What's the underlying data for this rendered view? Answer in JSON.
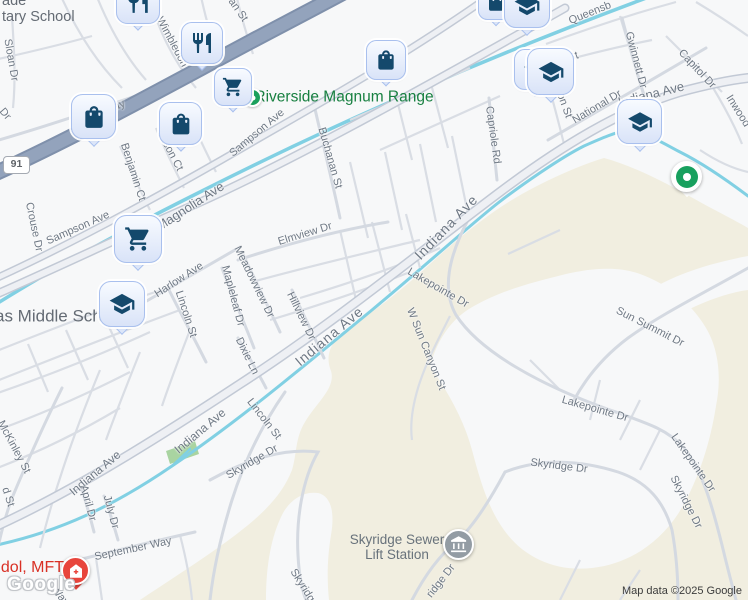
{
  "map": {
    "attribution": "Map data ©2025 Google",
    "watermark": "Google",
    "highway_badge": "91",
    "colors": {
      "urban": "#f7f8f9",
      "terrain": "#f1eee0",
      "water": "#81d0e3",
      "freeway": "#93a3bc",
      "arterial_casing": "#c2c9d5",
      "local_road": "#d9dde4",
      "park": "#a9d4a1",
      "pin_glyph": "#14496c",
      "pin_fill": "#dce6f9",
      "poi_green": "#188041",
      "poi_red": "#d93025",
      "label_gray": "#6e7884"
    },
    "place_labels": [
      {
        "name": "elementary-school-label",
        "lines": [
          "ade",
          "tary School"
        ],
        "x": 2,
        "y": -7,
        "s": 14.5,
        "cls": "schoolgray",
        "anchor": "tl"
      },
      {
        "name": "riverside-magnum-range-label",
        "lines": [
          "Riverside Magnum Range"
        ],
        "x": 344,
        "y": 97,
        "s": 15.5,
        "cls": "green",
        "anchor": "c"
      },
      {
        "name": "middle-school-label",
        "lines": [
          "gas Middle School"
        ],
        "x": 55,
        "y": 316,
        "s": 17,
        "cls": "schoolgray",
        "anchor": "c"
      },
      {
        "name": "therapist-label",
        "lines": [
          "udol, MFT"
        ],
        "x": 28,
        "y": 568,
        "s": 16,
        "cls": "red",
        "anchor": "c"
      },
      {
        "name": "sewer-lift-station-label",
        "lines": [
          "Skyridge Sewer",
          "Lift Station"
        ],
        "x": 397,
        "y": 547,
        "s": 13.5,
        "cls": "poigray",
        "anchor": "c"
      }
    ],
    "street_labels": [
      {
        "text": "Sloan Dr",
        "x": 11,
        "y": 60,
        "r": 80
      },
      {
        "text": "Dr",
        "x": 5,
        "y": 114,
        "r": 50
      },
      {
        "text": "Griffin Way",
        "x": 100,
        "y": 114,
        "r": -24
      },
      {
        "text": "Wimbledon",
        "x": 172,
        "y": 42,
        "r": 62
      },
      {
        "text": "an St",
        "x": 238,
        "y": 10,
        "r": 55
      },
      {
        "text": "Crouse Dr",
        "x": 34,
        "y": 227,
        "r": 78
      },
      {
        "text": "Sampson Ave",
        "x": 78,
        "y": 228,
        "r": -24
      },
      {
        "text": "Sampson Ave",
        "x": 257,
        "y": 133,
        "r": -40
      },
      {
        "text": "Magnolia Ave",
        "x": 190,
        "y": 206,
        "r": -33,
        "s": 13
      },
      {
        "text": "Benjamin Ct",
        "x": 133,
        "y": 172,
        "r": 72
      },
      {
        "text": "Jason Ct",
        "x": 170,
        "y": 151,
        "r": 62
      },
      {
        "text": "Buchanan St",
        "x": 330,
        "y": 158,
        "r": 74
      },
      {
        "text": "Elmview Dr",
        "x": 305,
        "y": 234,
        "r": -17
      },
      {
        "text": "Harlow Ave",
        "x": 179,
        "y": 280,
        "r": -33
      },
      {
        "text": "Lincoln St",
        "x": 186,
        "y": 314,
        "r": 72
      },
      {
        "text": "Mapleleaf Dr",
        "x": 233,
        "y": 296,
        "r": 75
      },
      {
        "text": "Meadowview Dr",
        "x": 254,
        "y": 282,
        "r": 64
      },
      {
        "text": "Hillview Dr",
        "x": 301,
        "y": 316,
        "r": 64
      },
      {
        "text": "Dixie Ln",
        "x": 247,
        "y": 356,
        "r": 64
      },
      {
        "text": "Indiana Ave",
        "x": 446,
        "y": 227,
        "r": -46,
        "s": 14,
        "ls": 1
      },
      {
        "text": "Indiana Ave",
        "x": 329,
        "y": 336,
        "r": -40,
        "s": 14,
        "ls": 1
      },
      {
        "text": "Indiana Ave",
        "x": 200,
        "y": 431,
        "r": -40,
        "s": 12
      },
      {
        "text": "Indiana Ave",
        "x": 95,
        "y": 473,
        "r": -40,
        "s": 12
      },
      {
        "text": "Indiana Ave",
        "x": 651,
        "y": 94,
        "r": -14,
        "s": 13
      },
      {
        "text": "Capriole Rd",
        "x": 493,
        "y": 135,
        "r": 82
      },
      {
        "text": "National Dr",
        "x": 597,
        "y": 107,
        "r": -31
      },
      {
        "text": "Gwinnett Dr",
        "x": 636,
        "y": 60,
        "r": 75
      },
      {
        "text": "Capitol Dr",
        "x": 697,
        "y": 69,
        "r": 47
      },
      {
        "text": "Queensb",
        "x": 590,
        "y": 13,
        "r": -22
      },
      {
        "text": "Inwood",
        "x": 738,
        "y": 111,
        "r": 58
      },
      {
        "text": "r St",
        "x": 570,
        "y": 58,
        "r": -20
      },
      {
        "text": "ton St",
        "x": 564,
        "y": 104,
        "r": 70
      },
      {
        "text": "Lakepointe Dr",
        "x": 438,
        "y": 288,
        "r": 30
      },
      {
        "text": "W Sun Canyon St",
        "x": 426,
        "y": 349,
        "r": 68
      },
      {
        "text": "Sun Summit Dr",
        "x": 650,
        "y": 327,
        "r": 27
      },
      {
        "text": "Lakepointe Dr",
        "x": 595,
        "y": 409,
        "r": 16
      },
      {
        "text": "Lakepointe Dr",
        "x": 693,
        "y": 463,
        "r": 55
      },
      {
        "text": "Skyridge Dr",
        "x": 559,
        "y": 466,
        "r": 7
      },
      {
        "text": "Skyridge Dr",
        "x": 686,
        "y": 502,
        "r": 63
      },
      {
        "text": "Skyridge Dr",
        "x": 252,
        "y": 462,
        "r": -30
      },
      {
        "text": "Skyridge",
        "x": 304,
        "y": 588,
        "r": 58
      },
      {
        "text": "ridge Dr",
        "x": 441,
        "y": 581,
        "r": -52
      },
      {
        "text": "Lincoln St",
        "x": 264,
        "y": 419,
        "r": 52
      },
      {
        "text": "McKinley St",
        "x": 14,
        "y": 447,
        "r": 62
      },
      {
        "text": "d St",
        "x": 8,
        "y": 497,
        "r": 72
      },
      {
        "text": "April Dr",
        "x": 88,
        "y": 503,
        "r": 75
      },
      {
        "text": "July Dr",
        "x": 111,
        "y": 512,
        "r": 75
      },
      {
        "text": "September Way",
        "x": 133,
        "y": 549,
        "r": -12
      },
      {
        "text": "Way",
        "x": 60,
        "y": 596,
        "r": 50
      }
    ],
    "pins": [
      {
        "name": "restaurant-pin",
        "icon": "restaurant-icon",
        "kind": "sq",
        "x": 116,
        "y": -20,
        "s": 44
      },
      {
        "name": "restaurant-pin",
        "icon": "restaurant-icon",
        "kind": "sq",
        "x": 181,
        "y": 22,
        "s": 42
      },
      {
        "name": "poi-dot",
        "icon": "green-dot-icon",
        "kind": "dot",
        "x": 243,
        "y": 88,
        "s": 19
      },
      {
        "name": "shopping-cart-pin",
        "icon": "shopping-cart-icon",
        "kind": "sq",
        "x": 214,
        "y": 68,
        "s": 38
      },
      {
        "name": "shopping-bag-pin",
        "icon": "shopping-bag-icon",
        "kind": "sq",
        "x": 366,
        "y": 40,
        "s": 40
      },
      {
        "name": "shopping-bag-pin",
        "icon": "shopping-bag-icon",
        "kind": "sq",
        "x": 478,
        "y": -16,
        "s": 36
      },
      {
        "name": "school-pin",
        "icon": "graduation-cap-icon",
        "kind": "sq",
        "x": 504,
        "y": -18,
        "s": 46
      },
      {
        "name": "school-pin",
        "icon": "graduation-cap-icon",
        "kind": "sq",
        "x": 514,
        "y": 49,
        "s": 41
      },
      {
        "name": "school-pin",
        "icon": "graduation-cap-icon",
        "kind": "sq",
        "x": 527,
        "y": 48,
        "s": 47
      },
      {
        "name": "school-pin",
        "icon": "graduation-cap-icon",
        "kind": "sq",
        "x": 617,
        "y": 99,
        "s": 45
      },
      {
        "name": "shopping-bag-pin",
        "icon": "shopping-bag-icon",
        "kind": "sq",
        "x": 71,
        "y": 94,
        "s": 45
      },
      {
        "name": "shopping-bag-pin",
        "icon": "shopping-bag-icon",
        "kind": "sq",
        "x": 159,
        "y": 102,
        "s": 43
      },
      {
        "name": "shopping-cart-pin",
        "icon": "shopping-cart-icon",
        "kind": "sq",
        "x": 114,
        "y": 215,
        "s": 48
      },
      {
        "name": "school-pin",
        "icon": "graduation-cap-icon",
        "kind": "sq",
        "x": 99,
        "y": 281,
        "s": 46
      },
      {
        "name": "park-pin",
        "icon": "park-dot-icon",
        "kind": "park",
        "x": 671,
        "y": 161,
        "s": 31
      },
      {
        "name": "health-pin",
        "icon": "medical-icon",
        "kind": "cred",
        "x": 61,
        "y": 556,
        "s": 29
      },
      {
        "name": "sewer-station-pin",
        "icon": "bank-icon",
        "kind": "cgray",
        "x": 443,
        "y": 529,
        "s": 31
      }
    ]
  }
}
